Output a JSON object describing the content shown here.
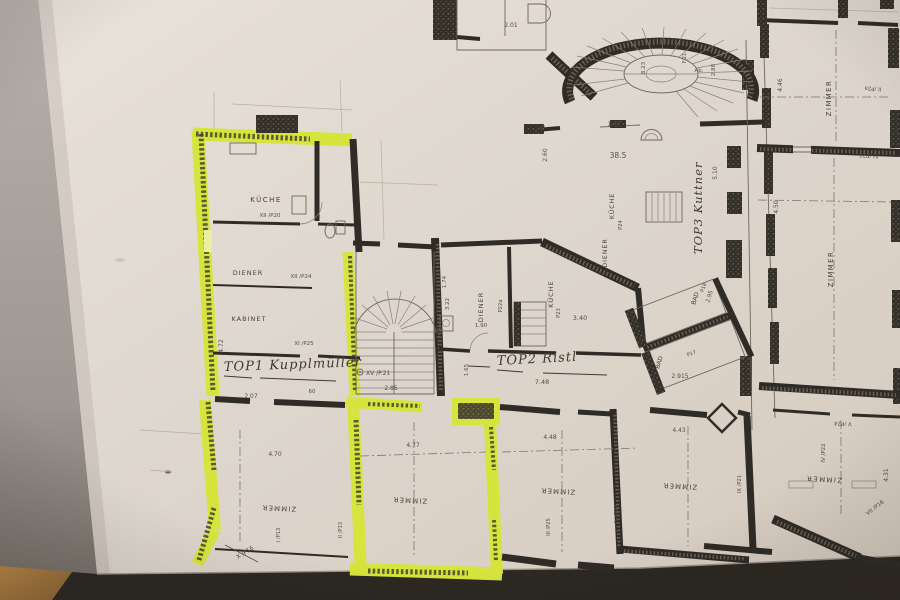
{
  "photo": {
    "background_color": "#2c2822",
    "paper_color": "#e0d9d1",
    "highlight_color": "#d7e43d",
    "table_color": "#b5824a"
  },
  "ann": {
    "top1": "TOP1 Kupplmüller",
    "top2": "TOP2 Ristl",
    "top3": "TOP3 Kuttner",
    "xv": "XV /P.21"
  },
  "rooms": [
    {
      "label": "KÜCHE",
      "code": "XII /P20"
    },
    {
      "label": "DIENER",
      "code": "XII /P24"
    },
    {
      "label": "KABINET",
      "code": "XI /P25"
    },
    {
      "label": "DIENER",
      "code": "P22a"
    },
    {
      "label": "KÜCHE",
      "code": "P23"
    },
    {
      "label": "KÜCHE",
      "code": "P24"
    },
    {
      "label": "DIENER"
    },
    {
      "label": "BAD",
      "code": "P18"
    },
    {
      "label": "BAD",
      "code": "P17"
    },
    {
      "label": "ZIMMER",
      "code": "II /P2a"
    },
    {
      "label": "ZIMMER",
      "code": "IV /P23"
    },
    {
      "label": "ZIMMER",
      "code": "IV /P22",
      "code2": "V /P24",
      "code3": "VII /P16"
    },
    {
      "label": "ZIMMER",
      "code": "I /P13",
      "code2": "X /P16"
    },
    {
      "label": "ZIMMER",
      "code": "II /P13"
    },
    {
      "label": "ZIMMER",
      "code": "III /P25"
    },
    {
      "label": "ZIMMER",
      "code": "IX /P21",
      "code2": "IV /P23"
    }
  ],
  "dims": [
    "4.72",
    "2.07",
    "60",
    "2.85",
    "7.48",
    "2.915",
    "3.40",
    "1.90",
    "38.5",
    "1.37",
    "2.60",
    "2.01",
    "P 14",
    "5.10",
    "2.88",
    "Ab.",
    "F.21",
    "8.23",
    "4.46",
    "4.50",
    "4.31",
    "2.95",
    "4.70",
    "4.77",
    "4.48",
    "4.43",
    "3.22",
    "1.74",
    "1.40",
    "1.65"
  ]
}
